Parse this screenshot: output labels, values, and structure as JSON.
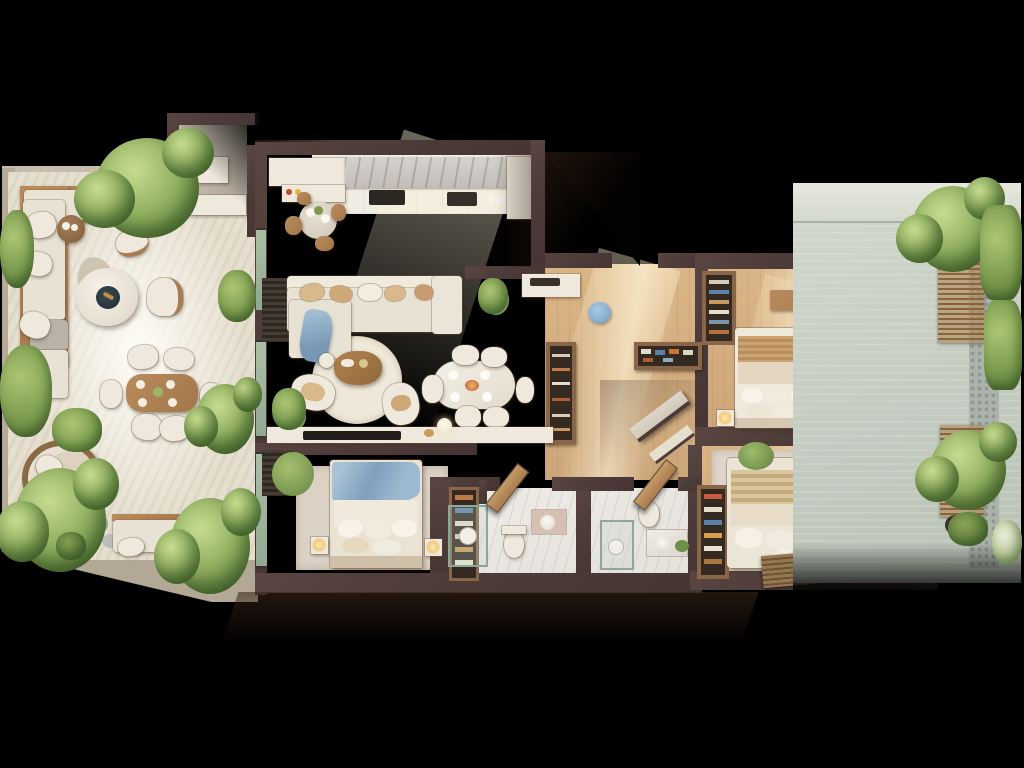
{
  "scene": {
    "title": "Top-view 3D render of an apartment floor plan with two garden terraces",
    "background": "#000000",
    "style": "photoreal dollhouse cutaway, walls cut at top, strong sunlight from upper right"
  },
  "palette": {
    "wall_cut": "#4d3c39",
    "wood_floor": "#cda67a",
    "kitchen_tile": "#f0ece3",
    "bathroom_marble": "#ebe8e2",
    "terrace_travertine": "#e6dfcf",
    "courtyard_concrete": "#c6cdc2",
    "upholstery": "#e9e3d6",
    "wood_furniture": "#ab7f52",
    "accent_blue": "#8fb3d0",
    "greenery": "#8fae5c",
    "bamboo_blind": "#8a6c49"
  },
  "rooms": {
    "terrace_left": {
      "label": "Left garden terrace with lounge, fire pit, outdoor dining and daybed"
    },
    "entry": {
      "label": "Entry vestibule with storage"
    },
    "kitchen": {
      "label": "Kitchen with counter run and round breakfast table"
    },
    "living": {
      "label": "Living room with L-sofa, round rug and coffee table"
    },
    "dining": {
      "label": "Indoor dining table for six"
    },
    "foyer": {
      "label": "Foyer with console bench and blue pouf"
    },
    "hallway": {
      "label": "Hallway with shoe shelf and wardrobes"
    },
    "bedroom_top_right": {
      "label": "Bedroom 1 with desk, wardrobe and window screens"
    },
    "bedroom_bottom_right": {
      "label": "Bedroom 2 with low bed and courtyard windows"
    },
    "bedroom_bottom_left": {
      "label": "Bedroom 3 with blue throw bed"
    },
    "bathroom_1": {
      "label": "Bathroom 1 with shower, toilet and vanity"
    },
    "bathroom_2": {
      "label": "Bathroom 2 with shower, toilet and vanity"
    },
    "terrace_right": {
      "label": "Right planted courtyard with wicker benches and vines"
    }
  },
  "furniture": {
    "outdoor_sofa": "L-shaped outdoor sofa on wood deck base",
    "fire_pit": "Round fire pit table",
    "side_table": "Round timber side table with two plates",
    "outdoor_dining": "Timber outdoor table with six cream chairs",
    "daybed": "Round wicker daybed",
    "garden_bench": "Cushioned garden bench",
    "sofa": "Cream modular sofa with blue throw",
    "coffee_table": "Round timber coffee table on circular rug",
    "tv_console": "Long media console with TV",
    "dining_table": "Oval dining table with six chairs",
    "display_cabinet": "Tall display cabinet",
    "console_bench": "Foyer console bench",
    "blue_pouf": "Round blue pouf",
    "shoe_shelf": "Open shoe shelf",
    "bed_1": "Double bed with striped throw and desk chair in blue",
    "bed_2": "Low double bed with cushions and blue pillows",
    "bed_3": "Double bed with blue blanket",
    "wardrobes": "Open wardrobes filled with clothes and shoes",
    "bath_fittings": "Glass shower, toilet, round-basin vanity, swing door"
  },
  "vegetation": {
    "trees": 9,
    "bushes": 7,
    "vines": "climbing greenery along right courtyard wall"
  }
}
